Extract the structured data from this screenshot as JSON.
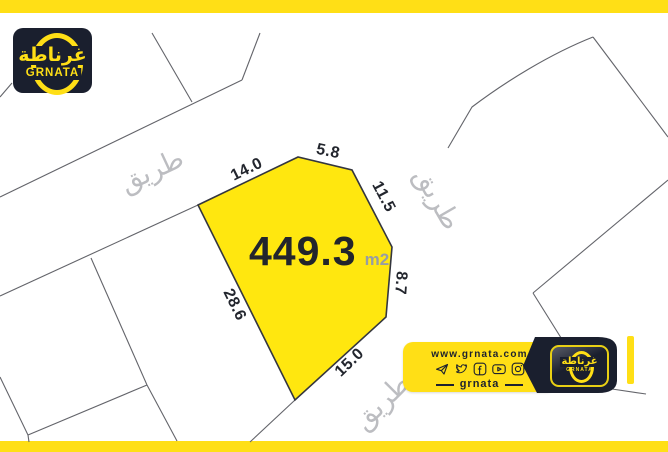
{
  "colors": {
    "brand_yellow": "#ffdf16",
    "plot_yellow": "#ffe70f",
    "dark_navy": "#1a1f2e",
    "parcel_line_gray": "#63646a",
    "road_text_gray": "#bcbdc1",
    "dimension_text": "#23262e",
    "area_unit_gray": "#979da5"
  },
  "logo": {
    "arabic": "غرناطة",
    "latin": "GRNATA"
  },
  "plot": {
    "area_value": "449.3",
    "area_unit": "m2",
    "dimensions": [
      {
        "label": "14.0",
        "side": "top-left"
      },
      {
        "label": "5.8",
        "side": "top"
      },
      {
        "label": "11.5",
        "side": "upper-right"
      },
      {
        "label": "8.7",
        "side": "lower-right"
      },
      {
        "label": "15.0",
        "side": "bottom"
      },
      {
        "label": "28.6",
        "side": "left"
      }
    ]
  },
  "roads": [
    {
      "label": "طريق",
      "position": "upper-left"
    },
    {
      "label": "طريق",
      "position": "right"
    },
    {
      "label": "طريق",
      "position": "bottom"
    }
  ],
  "banner": {
    "website_prefix": "www.",
    "website_name": "grnata",
    "website_suffix": ".com",
    "handle": "grnata",
    "social_icons": [
      "telegram-icon",
      "twitter-icon",
      "facebook-icon",
      "youtube-icon",
      "instagram-icon"
    ]
  }
}
